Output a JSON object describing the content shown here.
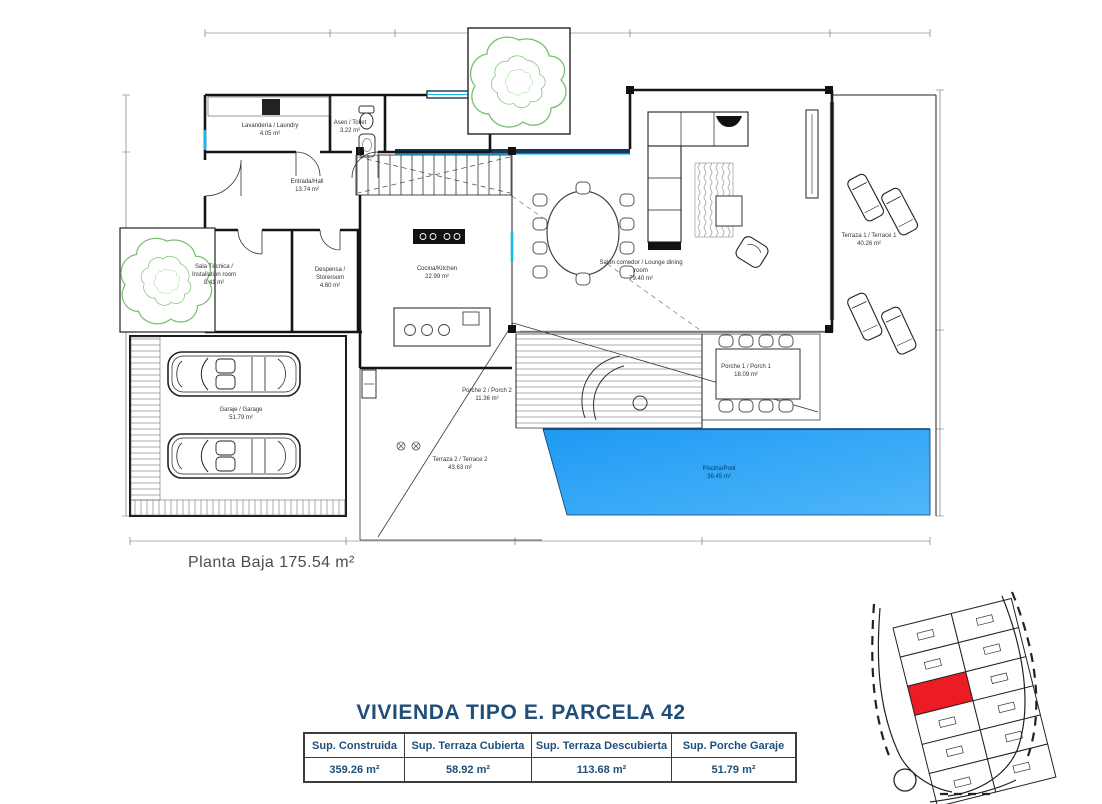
{
  "title": "VIVIENDA TIPO E. PARCELA 42",
  "plan": {
    "floor_label": "Planta Baja 175.54 m²",
    "rooms": [
      {
        "name": "Lavandería / Laundry",
        "area": "4.05 m²"
      },
      {
        "name": "Aseo / Toilet",
        "area": "3.22 m²"
      },
      {
        "name": "Entrada/Hall",
        "area": "13.74 m²"
      },
      {
        "name": "Sala Técnica / Installation room",
        "area": "8.41 m²"
      },
      {
        "name": "Despensa / Storeroom",
        "area": "4.60 m²"
      },
      {
        "name": "Cocina/Kitchen",
        "area": "22.99 m²"
      },
      {
        "name": "Salón comedor / Lounge dining room",
        "area": "79.40 m²"
      },
      {
        "name": "Terraza 1 / Terrace 1",
        "area": "40.26 m²"
      },
      {
        "name": "Garaje / Garage",
        "area": "51.79 m²"
      },
      {
        "name": "Porche 2 / Porch 2",
        "area": "11.36 m²"
      },
      {
        "name": "Porche 1 / Porch 1",
        "area": "18.09 m²"
      },
      {
        "name": "Terraza 2 / Terrace 2",
        "area": "43.63 m²"
      },
      {
        "name": "Piscina/Pool",
        "area": "36.45 m²"
      }
    ]
  },
  "summary_table": {
    "headers": [
      "Sup. Construida",
      "Sup. Terraza Cubierta",
      "Sup. Terraza Descubierta",
      "Sup. Porche Garaje"
    ],
    "values": [
      "359.26 m²",
      "58.92 m²",
      "113.68 m²",
      "51.79 m²"
    ]
  },
  "colors": {
    "pool_blue": "#2aa4f5",
    "window_blue": "#18b7ea",
    "title_navy": "#1f4e79",
    "parcel_red": "#ec1c24",
    "tree_green": "#76c06c",
    "floor_label_gray": "#4d4d4d"
  }
}
